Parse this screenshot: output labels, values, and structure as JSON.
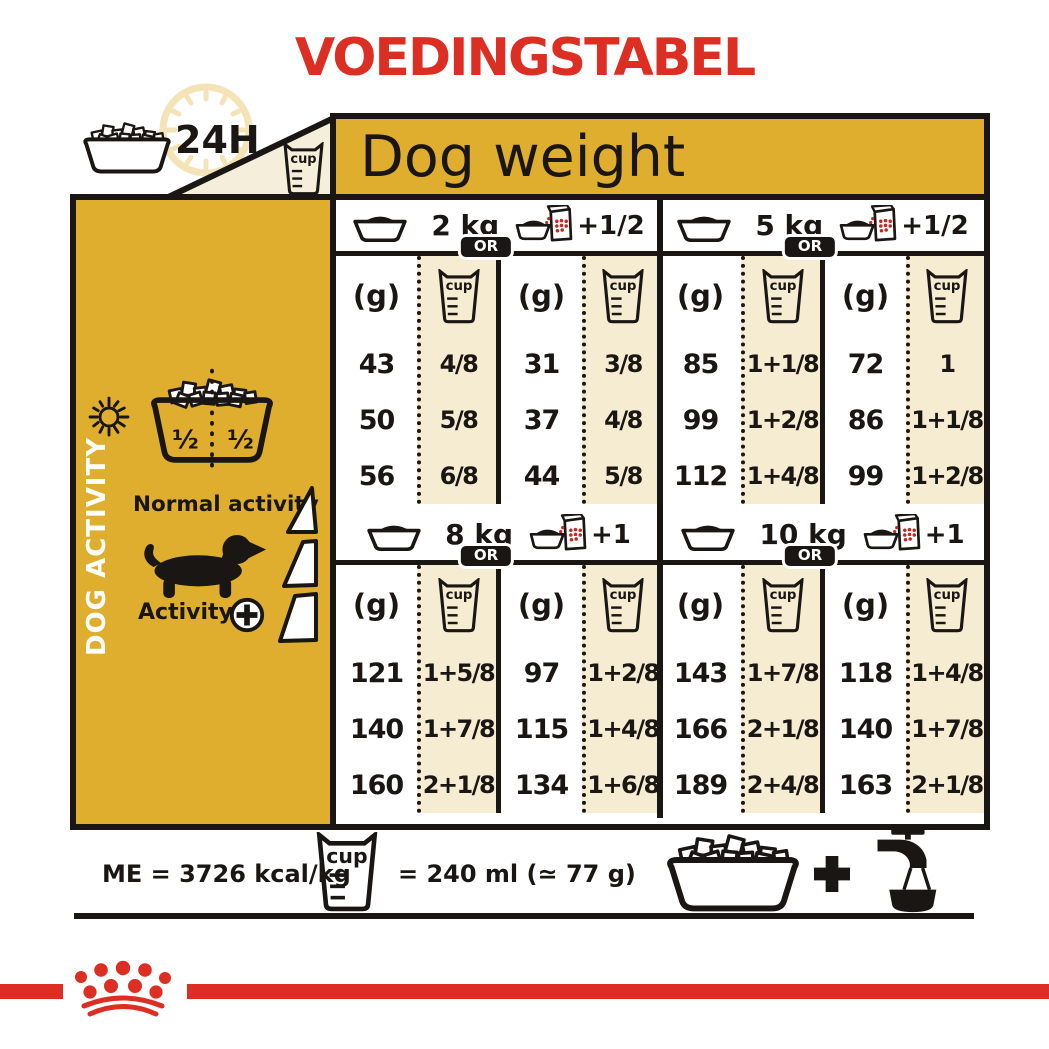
{
  "title": "VOEDINGSTABEL",
  "labels": {
    "cup": "cup",
    "or": "OR",
    "grams": "(g)",
    "hours": "24H"
  },
  "colors": {
    "brand_red": "#DC2E22",
    "gold": "#DFAE2F",
    "cream": "#F6ECD2",
    "ink": "#1A1613"
  },
  "table": {
    "header": "Dog weight",
    "sections": [
      {
        "weight": "2 kg",
        "wet_add": "+1/2",
        "dry": {
          "rows": [
            {
              "g": "43",
              "cup": "4/8"
            },
            {
              "g": "50",
              "cup": "5/8"
            },
            {
              "g": "56",
              "cup": "6/8"
            }
          ]
        },
        "mixed": {
          "rows": [
            {
              "g": "31",
              "cup": "3/8"
            },
            {
              "g": "37",
              "cup": "4/8"
            },
            {
              "g": "44",
              "cup": "5/8"
            }
          ]
        }
      },
      {
        "weight": "5 kg",
        "wet_add": "+1/2",
        "dry": {
          "rows": [
            {
              "g": "85",
              "cup": "1+1/8"
            },
            {
              "g": "99",
              "cup": "1+2/8"
            },
            {
              "g": "112",
              "cup": "1+4/8"
            }
          ]
        },
        "mixed": {
          "rows": [
            {
              "g": "72",
              "cup": "1"
            },
            {
              "g": "86",
              "cup": "1+1/8"
            },
            {
              "g": "99",
              "cup": "1+2/8"
            }
          ]
        }
      },
      {
        "weight": "8 kg",
        "wet_add": "+1",
        "dry": {
          "rows": [
            {
              "g": "121",
              "cup": "1+5/8"
            },
            {
              "g": "140",
              "cup": "1+7/8"
            },
            {
              "g": "160",
              "cup": "2+1/8"
            }
          ]
        },
        "mixed": {
          "rows": [
            {
              "g": "97",
              "cup": "1+2/8"
            },
            {
              "g": "115",
              "cup": "1+4/8"
            },
            {
              "g": "134",
              "cup": "1+6/8"
            }
          ]
        }
      },
      {
        "weight": "10 kg",
        "wet_add": "+1",
        "dry": {
          "rows": [
            {
              "g": "143",
              "cup": "1+7/8"
            },
            {
              "g": "166",
              "cup": "2+1/8"
            },
            {
              "g": "189",
              "cup": "2+4/8"
            }
          ]
        },
        "mixed": {
          "rows": [
            {
              "g": "118",
              "cup": "1+4/8"
            },
            {
              "g": "140",
              "cup": "1+7/8"
            },
            {
              "g": "163",
              "cup": "2+1/8"
            }
          ]
        }
      }
    ]
  },
  "sidebar": {
    "vertical_label": "DOG ACTIVITY",
    "half_left": "½",
    "half_right": "½",
    "normal_activity": "Normal activity",
    "activity": "Activity"
  },
  "footer": {
    "energy": "ME = 3726 kcal/kg",
    "cup_equiv": "= 240 ml (≃ 77 g)"
  }
}
